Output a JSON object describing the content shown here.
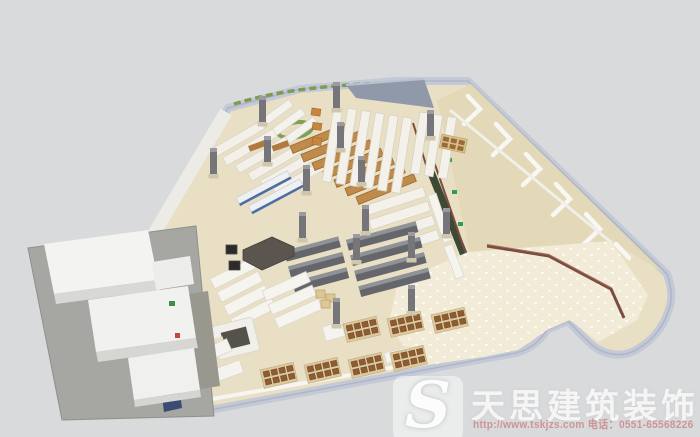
{
  "watermark": {
    "logo_letter": "S",
    "brand": "天思建筑装饰",
    "website": "http://www.tskjzs.com",
    "phone_label": " 电话：",
    "phone": "0551-65568226"
  },
  "palette": {
    "background": "#d9dadb",
    "outer_wall_band": "#c3c9d6",
    "wall_white": "#f6f5f1",
    "floor_beige": "#e9dfc4",
    "plaza_floor": "#f1ebd8",
    "backroom_floor": "#e3d8b8",
    "roof_band_gray": "#8f99a9",
    "shelf_white": "#f3f1ea",
    "shelf_wood": "#c08a4b",
    "freezer_gray": "#64666b",
    "pallet_brown": "#8d5c31",
    "green_partition_wall": "#3c4a35",
    "plant_garland_green": "#7e9b51",
    "exit_sign_green": "#2f9e53",
    "railing_maroon": "#7b4c40",
    "escalator_navy": "#3a4c72",
    "watermark_white": "rgba(255,255,255,0.78)",
    "watermark_red": "rgba(197,98,98,0.58)"
  }
}
